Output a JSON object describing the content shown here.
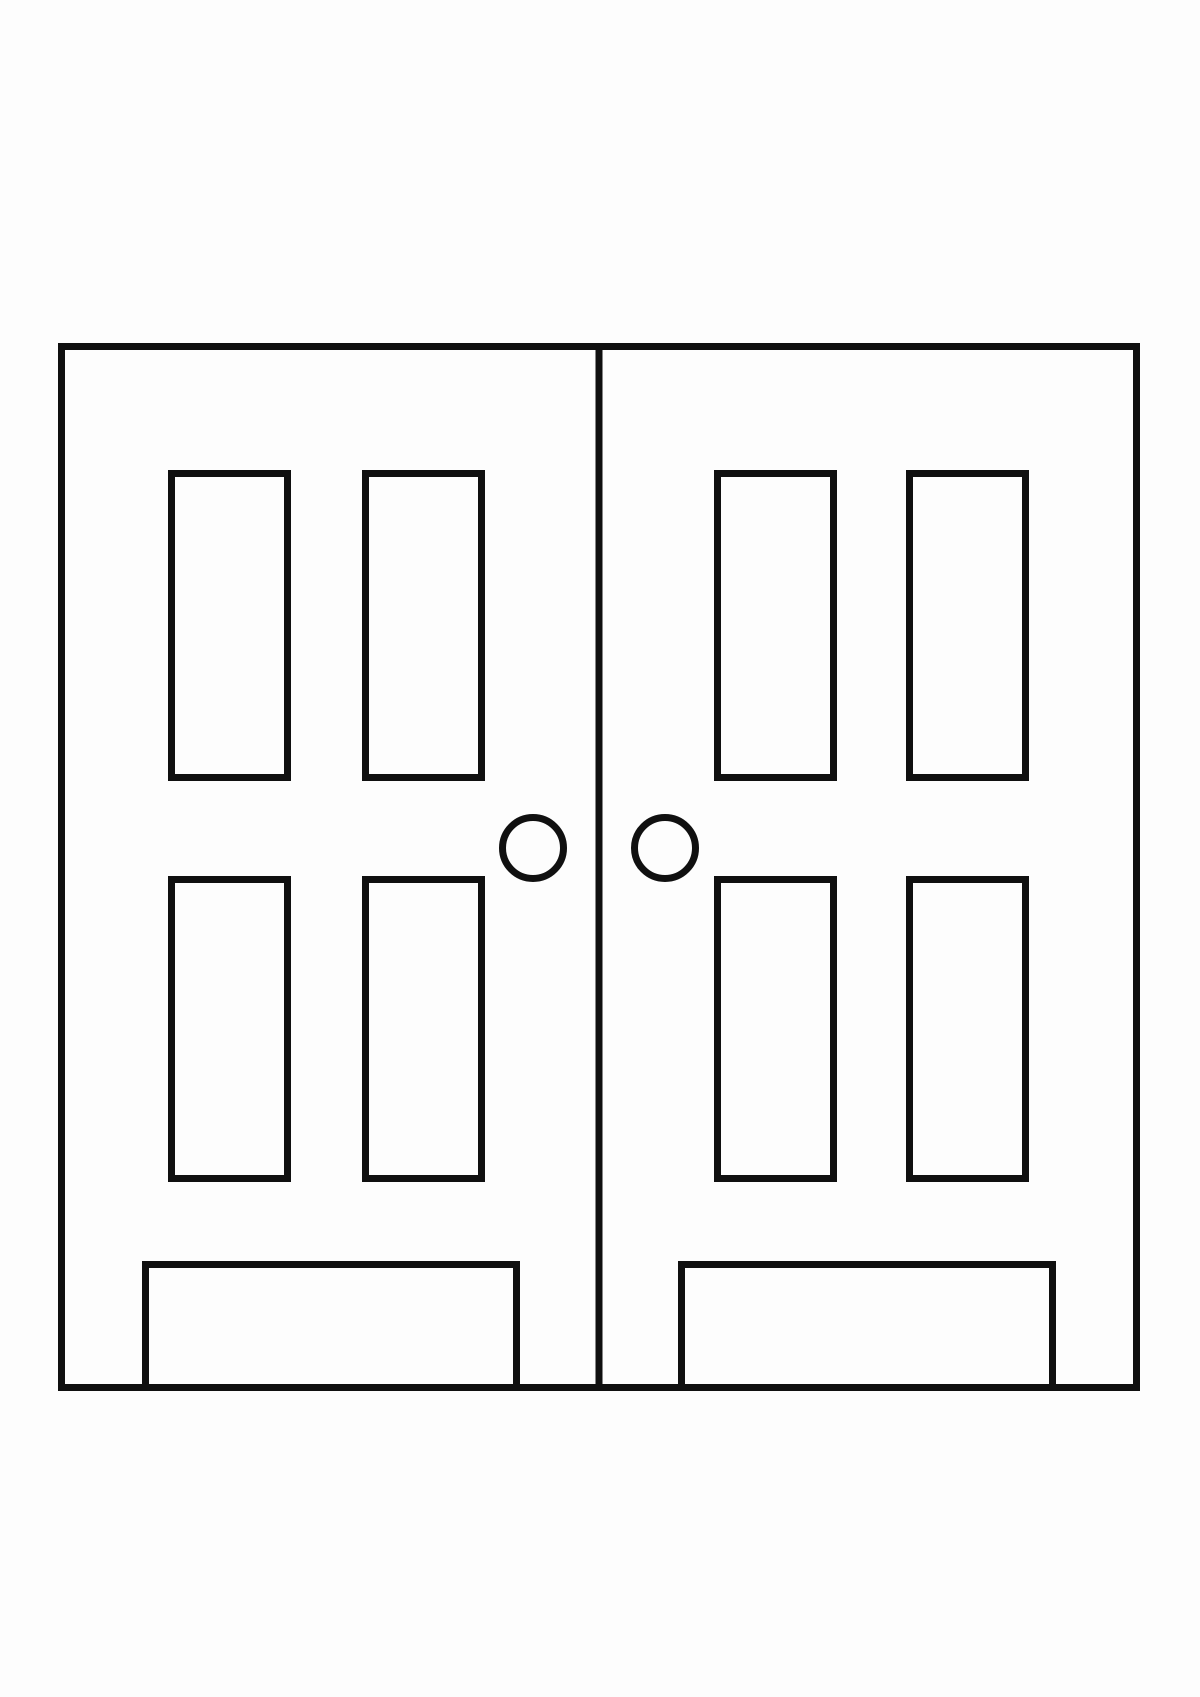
{
  "drawing": {
    "title": "double-doors-coloring-page-line-art",
    "background_color": "#fdfdfd",
    "line_color": "#101010",
    "stroke_width": 7,
    "canvas": {
      "width": 1200,
      "height": 1697
    },
    "outer_frame": {
      "name": "door-frame-outline",
      "x": 61.5,
      "y": 346.5,
      "width": 1075,
      "height": 1041
    },
    "center_divider": {
      "name": "door-divider-line",
      "x": 599,
      "y1": 346.5,
      "y2": 1387.5
    },
    "panels": [
      {
        "name": "left-door-panel-top-left",
        "x": 171.5,
        "y": 473.5,
        "width": 116,
        "height": 304
      },
      {
        "name": "left-door-panel-top-right",
        "x": 365.5,
        "y": 473.5,
        "width": 116,
        "height": 304
      },
      {
        "name": "right-door-panel-top-left",
        "x": 717.5,
        "y": 473.5,
        "width": 116,
        "height": 304
      },
      {
        "name": "right-door-panel-top-right",
        "x": 909.5,
        "y": 473.5,
        "width": 116,
        "height": 304
      },
      {
        "name": "left-door-panel-bottom-left",
        "x": 171.5,
        "y": 879.5,
        "width": 116,
        "height": 299
      },
      {
        "name": "left-door-panel-bottom-right",
        "x": 365.5,
        "y": 879.5,
        "width": 116,
        "height": 299
      },
      {
        "name": "right-door-panel-bottom-left",
        "x": 717.5,
        "y": 879.5,
        "width": 116,
        "height": 299
      },
      {
        "name": "right-door-panel-bottom-right",
        "x": 909.5,
        "y": 879.5,
        "width": 116,
        "height": 299
      }
    ],
    "knobs": [
      {
        "name": "left-door-knob",
        "cx": 533,
        "cy": 848,
        "r": 30.5
      },
      {
        "name": "right-door-knob",
        "cx": 665,
        "cy": 848,
        "r": 30.5
      }
    ],
    "kick_plates": [
      {
        "name": "left-door-kick-plate",
        "x": 145.5,
        "y": 1264.5,
        "width": 371,
        "height": 123
      },
      {
        "name": "right-door-kick-plate",
        "x": 681.5,
        "y": 1264.5,
        "width": 371,
        "height": 123
      }
    ]
  }
}
